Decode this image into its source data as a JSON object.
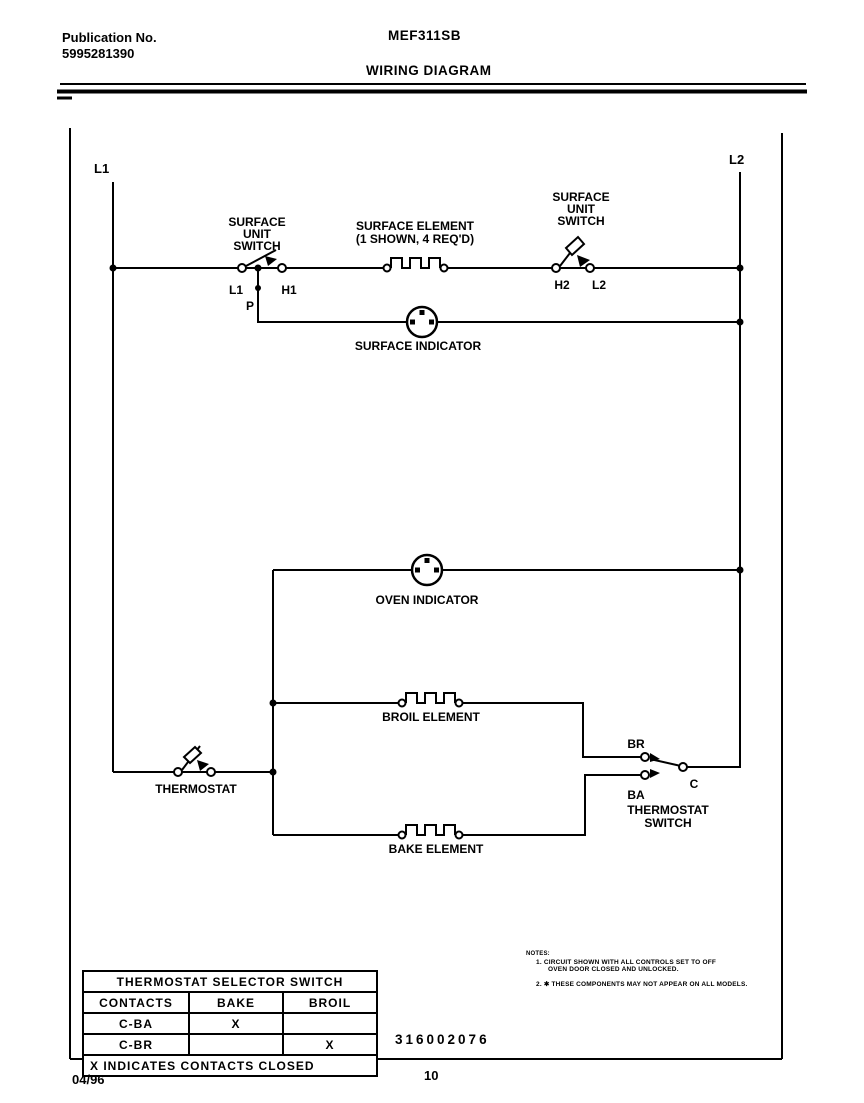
{
  "header": {
    "publication_label": "Publication No.",
    "publication_number": "5995281390",
    "model": "MEF311SB",
    "title": "WIRING DIAGRAM"
  },
  "diagram": {
    "l1_rail_label": "L1",
    "l2_rail_label": "L2",
    "surface_unit_switch_left": {
      "line1": "SURFACE",
      "line2": "UNIT",
      "line3": "SWITCH",
      "terminal_l1": "L1",
      "terminal_h1": "H1",
      "terminal_p": "P"
    },
    "surface_element": {
      "line1": "SURFACE ELEMENT",
      "line2": "(1 SHOWN, 4 REQ'D)"
    },
    "surface_unit_switch_right": {
      "line1": "SURFACE",
      "line2": "UNIT",
      "line3": "SWITCH",
      "terminal_h2": "H2",
      "terminal_l2": "L2"
    },
    "surface_indicator_label": "SURFACE INDICATOR",
    "oven_indicator_label": "OVEN INDICATOR",
    "broil_element_label": "BROIL ELEMENT",
    "bake_element_label": "BAKE ELEMENT",
    "thermostat_label": "THERMOSTAT",
    "thermostat_switch": {
      "terminal_br": "BR",
      "terminal_ba": "BA",
      "terminal_c": "C",
      "line1": "THERMOSTAT",
      "line2": "SWITCH"
    },
    "part_number": "316002076"
  },
  "notes": {
    "heading": "NOTES:",
    "note1_line1": "1. CIRCUIT SHOWN WITH ALL CONTROLS SET TO OFF",
    "note1_line2": "OVEN DOOR CLOSED AND UNLOCKED.",
    "note2": "2. ✱ THESE COMPONENTS MAY NOT APPEAR ON ALL MODELS."
  },
  "table": {
    "title": "THERMOSTAT SELECTOR SWITCH",
    "columns": [
      "CONTACTS",
      "BAKE",
      "BROIL"
    ],
    "rows": [
      {
        "contact": "C-BA",
        "bake": "X",
        "broil": ""
      },
      {
        "contact": "C-BR",
        "bake": "",
        "broil": "X"
      }
    ],
    "footnote": "X INDICATES CONTACTS CLOSED"
  },
  "footer": {
    "date": "04/96",
    "page": "10"
  },
  "colors": {
    "ink": "#000000",
    "paper": "#ffffff"
  }
}
